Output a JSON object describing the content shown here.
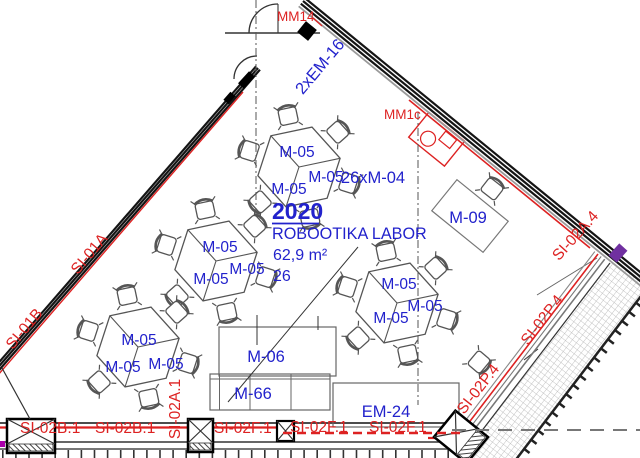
{
  "room": {
    "number": "2020",
    "name": "ROBOOTIKA LABOR",
    "area": "62,9 m²",
    "capacity": "26"
  },
  "furniture": {
    "group_table": "M-05",
    "cabinet_m06": "M-06",
    "cabinet_m66": "M-66",
    "desk_m09": "M-09",
    "equip_em24": "EM-24",
    "chairs": "26xM-04",
    "doors": "2xEM-16"
  },
  "wall_tags": {
    "si_01a": "SI-01A",
    "si_01b": "SI-01B",
    "si_02b_1": "SI-02B.1",
    "si_02a_1": "SI-02A.1",
    "si_02f_1": "SI-02F.1",
    "si_02p_4": "SI-02P.4",
    "si_02a_4": "SI-02A.4"
  },
  "fixtures": {
    "mm14": "MM14",
    "mm1c": "MM1c"
  },
  "colors": {
    "annotation_blue": "#2222cc",
    "tag_red": "#dd2222",
    "wall_black": "#141414",
    "accent_purple": "#7030a0"
  }
}
